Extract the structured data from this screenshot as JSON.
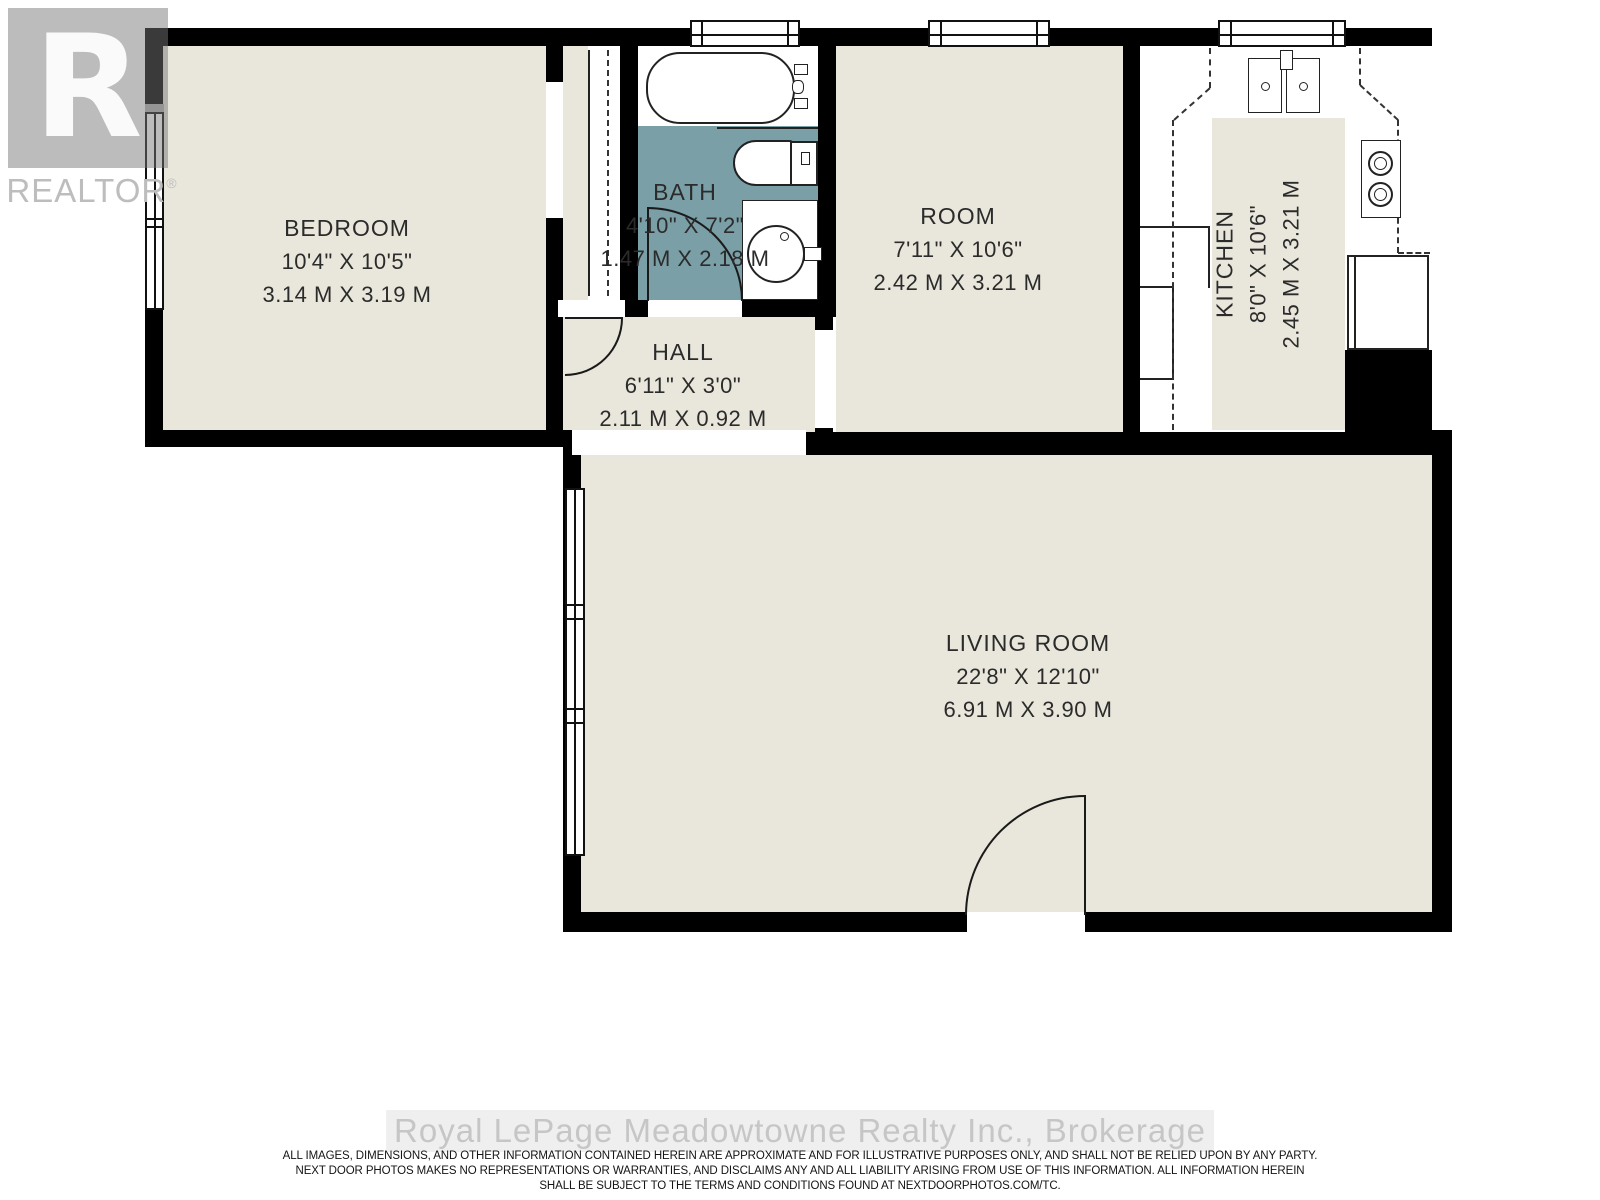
{
  "branding": {
    "logo_letter": "R",
    "logo_text": "REALTOR",
    "registered_mark": "®"
  },
  "watermark": {
    "text": "Royal LePage Meadowtowne Realty Inc., Brokerage"
  },
  "disclaimer": {
    "line1": "ALL IMAGES, DIMENSIONS, AND OTHER INFORMATION CONTAINED HEREIN ARE APPROXIMATE AND FOR ILLUSTRATIVE PURPOSES ONLY, AND SHALL NOT BE RELIED UPON BY ANY PARTY.",
    "line2": "NEXT DOOR PHOTOS MAKES NO REPRESENTATIONS OR WARRANTIES, AND DISCLAIMS ANY AND ALL LIABILITY ARISING FROM USE OF THIS INFORMATION. ALL INFORMATION HEREIN",
    "line3": "SHALL BE SUBJECT TO THE TERMS AND CONDITIONS FOUND AT NEXTDOORPHOTOS.COM/TC."
  },
  "rooms": [
    {
      "name": "BEDROOM",
      "imperial": "10'4\" X 10'5\"",
      "metric": "3.14 M X 3.19 M"
    },
    {
      "name": "BATH",
      "imperial": "4'10\" X 7'2\"",
      "metric": "1.47 M X 2.18 M"
    },
    {
      "name": "HALL",
      "imperial": "6'11\" X 3'0\"",
      "metric": "2.11 M X 0.92 M"
    },
    {
      "name": "ROOM",
      "imperial": "7'11\" X 10'6\"",
      "metric": "2.42 M X 3.21 M"
    },
    {
      "name": "KITCHEN",
      "imperial": "8'0\" X 10'6\"",
      "metric": "2.45 M X 3.21 M"
    },
    {
      "name": "LIVING ROOM",
      "imperial": "22'8\" X 12'10\"",
      "metric": "6.91 M X 3.90 M"
    }
  ],
  "fixtures": [
    "bathtub",
    "toilet",
    "vanity-sink",
    "kitchen-double-sink",
    "stove",
    "refrigerator"
  ],
  "colors": {
    "floor": "#e9e7db",
    "bath_floor": "#7a9fa7",
    "wall": "#000000",
    "logo_gray": "#bdbdbd",
    "watermark_gray": "#c6c6c6",
    "label_text": "#2b2b2b"
  }
}
